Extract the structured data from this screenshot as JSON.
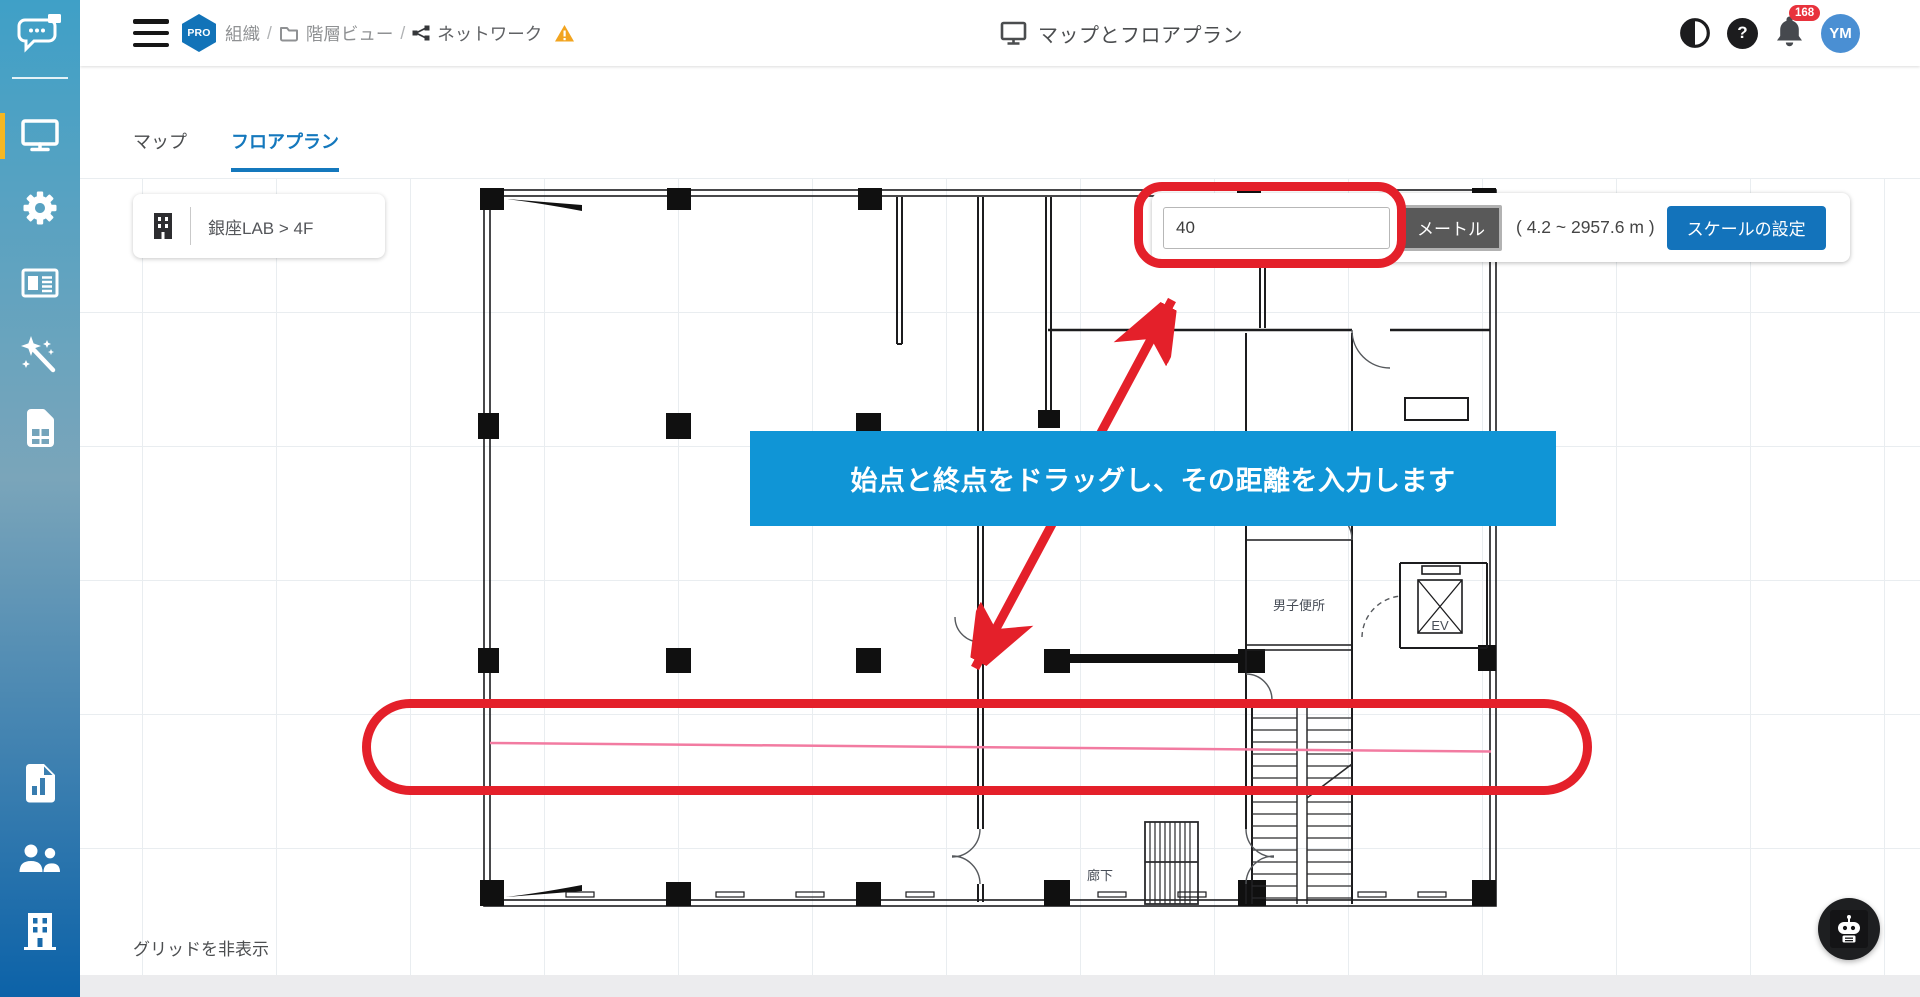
{
  "sidebar": {
    "nav_icons": [
      "chat-logo",
      "monitor",
      "gear",
      "newspaper",
      "magic-wand",
      "sim-card"
    ],
    "secondary_icons": [
      "report",
      "users",
      "building"
    ],
    "active_item": "monitor"
  },
  "header": {
    "pro_badge": "PRO",
    "breadcrumb": [
      {
        "label": "組織"
      },
      {
        "label": "階層ビュー",
        "icon": "folder"
      },
      {
        "label": "ネットワーク",
        "icon": "network"
      }
    ],
    "breadcrumb_separator": "/",
    "title": "マップとフロアプラン",
    "help_glyph": "?",
    "notification_count": "168",
    "avatar_initials": "YM"
  },
  "tabs": {
    "map_label": "マップ",
    "floorplan_label": "フロアプラン",
    "active": "フロアプラン"
  },
  "location_selector": {
    "label": "銀座LAB > 4F"
  },
  "scale_toolbar": {
    "distance_value": "40",
    "unit_label": "メートル",
    "range_hint": "( 4.2 ~ 2957.6 m )",
    "apply_label": "スケールの設定"
  },
  "instruction_banner": {
    "text": "始点と終点をドラッグし、その距離を入力します"
  },
  "floor_plan": {
    "room_labels": {
      "mens_restroom": "男子便所",
      "elevator": "EV",
      "corridor": "廊下"
    }
  },
  "canvas_footer": {
    "grid_toggle_label": "グリッドを非表示"
  },
  "colors": {
    "accent_blue": "#1373bb",
    "tab_blue": "#1478bd",
    "banner_blue": "#1095d6",
    "annotation_red": "#e4202a",
    "measure_pink": "#f27ba1",
    "active_indicator_yellow": "#f5b722",
    "badge_red": "#e8323c",
    "avatar_blue": "#4a8fd3"
  }
}
